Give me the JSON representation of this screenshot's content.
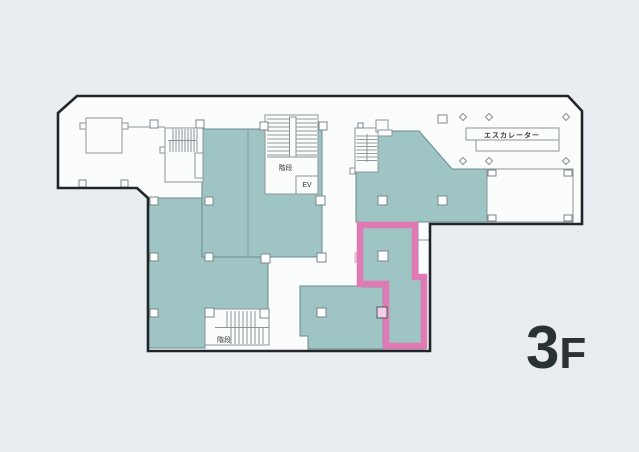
{
  "page": {
    "floor_number": "3",
    "floor_suffix": "F"
  },
  "labels": {
    "escalator": "エスカレーター",
    "stairs_upper": "階段",
    "stairs_lower": "階段",
    "elevator": "EV"
  },
  "colors": {
    "background": "#e9edf2",
    "paper": "#fbfcfc",
    "room_fill": "#9ec5c3",
    "room_border": "#6b8a8c",
    "outline": "#212629",
    "wall": "#8b9599",
    "hatch": "#6f7a7e",
    "highlight": "#e07ab4",
    "highlight_light": "#f3cfe7",
    "text_dark": "#2b3236",
    "text": "#35393c"
  }
}
